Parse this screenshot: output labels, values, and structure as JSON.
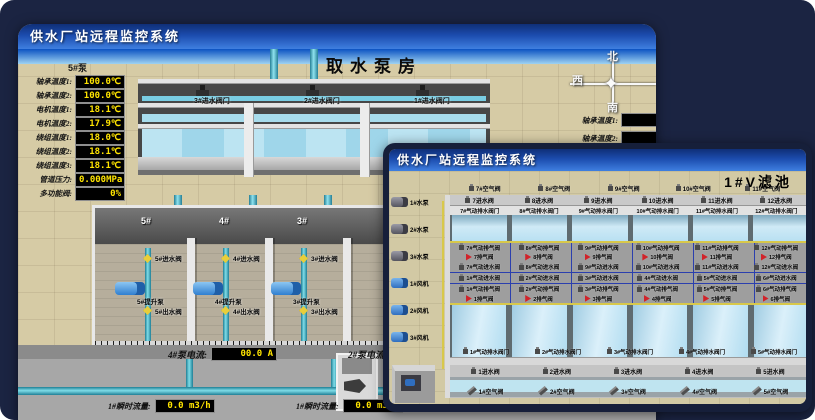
{
  "back_window": {
    "title": "供水厂站远程监控系统",
    "scene_title": "取水泵房",
    "pump_panel": {
      "pump_label": "5#泵",
      "fields": [
        {
          "label": "轴承温度1:",
          "value": "100.0℃"
        },
        {
          "label": "轴承温度2:",
          "value": "100.0℃"
        },
        {
          "label": "电机温度1:",
          "value": "18.1℃"
        },
        {
          "label": "电机温度2:",
          "value": "17.9℃"
        },
        {
          "label": "绕组温度1:",
          "value": "18.0℃"
        },
        {
          "label": "绕组温度2:",
          "value": "18.1℃"
        },
        {
          "label": "绕组温度3:",
          "value": "18.1℃"
        },
        {
          "label": "管道压力:",
          "value": "0.000MPa"
        },
        {
          "label": "多功能阀:",
          "value": "0%"
        }
      ]
    },
    "intake_valves": [
      "3#进水阀门",
      "2#进水阀门",
      "1#进水阀门"
    ],
    "compass": {
      "north": "北",
      "west": "西",
      "south": "南"
    },
    "side_labels": [
      "轴承温度1:",
      "轴承温度2:"
    ],
    "bay_numbers": [
      "5#",
      "4#",
      "3#"
    ],
    "bays": [
      {
        "inlet": "5#进水阀",
        "pump": "5#提升泵",
        "outlet": "5#出水阀"
      },
      {
        "inlet": "4#进水阀",
        "pump": "4#提升泵",
        "outlet": "4#出水阀"
      },
      {
        "inlet": "3#进水阀",
        "pump": "3#提升泵",
        "outlet": "3#出水阀"
      }
    ],
    "current_readouts": [
      {
        "label": "4#泵电流:",
        "value": "00.0 A"
      },
      {
        "label": "2#泵电流:",
        "value": ""
      }
    ],
    "flow_readouts": [
      {
        "label": "1#瞬时流量:",
        "value": "0.0 m3/h"
      },
      {
        "label": "1#瞬时流量:",
        "value": "0.0 m3/h"
      }
    ]
  },
  "front_window": {
    "title": "供水厂站远程监控系统",
    "scene_title": "1#V滤池",
    "left_devices": [
      "1#水泵",
      "2#水泵",
      "3#水泵",
      "1#风机",
      "2#风机",
      "3#风机"
    ],
    "valve_rows": {
      "air_top": [
        "7#空气阀",
        "8#空气阀",
        "9#空气阀",
        "10#空气阀",
        "11#空气阀",
        "12#空气阀"
      ],
      "inlet_top": [
        "7进水阀",
        "8进水阀",
        "9进水阀",
        "10进水阀",
        "11进水阀",
        "12进水阀"
      ],
      "drain_top": [
        "7#气动排水阀门",
        "8#气动排水阀门",
        "9#气动排水阀门",
        "10#气动排水阀门",
        "11#气动排水阀门",
        "12#气动排水阀门"
      ],
      "pneu_exhaust_top": [
        "7#气动排气阀",
        "8#气动排气阀",
        "9#气动排气阀",
        "10#气动排气阀",
        "11#气动排气阀",
        "12#气动排气阀"
      ],
      "exhaust_top": [
        "7排气阀",
        "8排气阀",
        "9排气阀",
        "10排气阀",
        "11排气阀",
        "12排气阀"
      ],
      "pneu_inlet_top": [
        "7#气动进水阀",
        "8#气动进水阀",
        "9#气动进水阀",
        "10#气动进水阀",
        "11#气动进水阀",
        "12#气动进水阀"
      ],
      "pneu_inlet_bottom": [
        "1#气动进水阀",
        "2#气动进水阀",
        "3#气动进水阀",
        "4#气动进水阀",
        "5#气动进水阀",
        "6#气动进水阀"
      ],
      "pneu_exhaust_bottom": [
        "1#气动排气阀",
        "2#气动排气阀",
        "3#气动排气阀",
        "4#气动排气阀",
        "5#气动排气阀",
        "6#气动排气阀"
      ],
      "exhaust_bottom": [
        "1排气阀",
        "2排气阀",
        "3排气阀",
        "4排气阀",
        "5排气阀",
        "6排气阀"
      ],
      "drain_bottom": [
        "1#气动排水阀门",
        "2#气动排水阀门",
        "3#气动排水阀门",
        "4#气动排水阀门",
        "5#气动排水阀门"
      ],
      "inlet_bottom": [
        "1进水阀",
        "2进水阀",
        "3进水阀",
        "4进水阀",
        "5进水阀"
      ],
      "air_bottom": [
        "1#空气阀",
        "2#空气阀",
        "3#空气阀",
        "4#空气阀",
        "5#空气阀"
      ]
    }
  },
  "colors": {
    "background": "#1b2442",
    "titlebar_blue": "#1c4cae",
    "readout_bg": "#000000",
    "readout_text": "#ffe400",
    "alarm_red": "#d1232a",
    "pipe_cyan": "#49b8cc",
    "pipe_yellow": "#d8c84a",
    "water_blue": "#b9e0f2"
  }
}
